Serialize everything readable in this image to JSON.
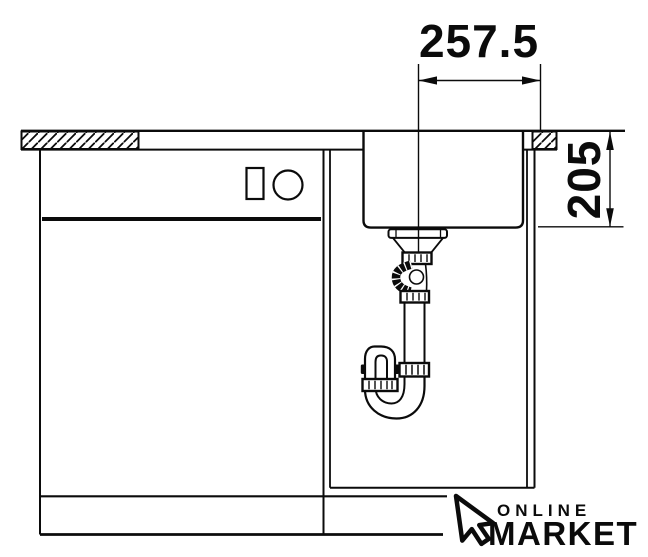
{
  "dimensions": {
    "width": "257.5",
    "depth": "205"
  },
  "logo": {
    "top": "ONLINE",
    "bottom": "MARKET"
  },
  "colors": {
    "ink": "#0b0b0b",
    "paper": "#ffffff"
  }
}
